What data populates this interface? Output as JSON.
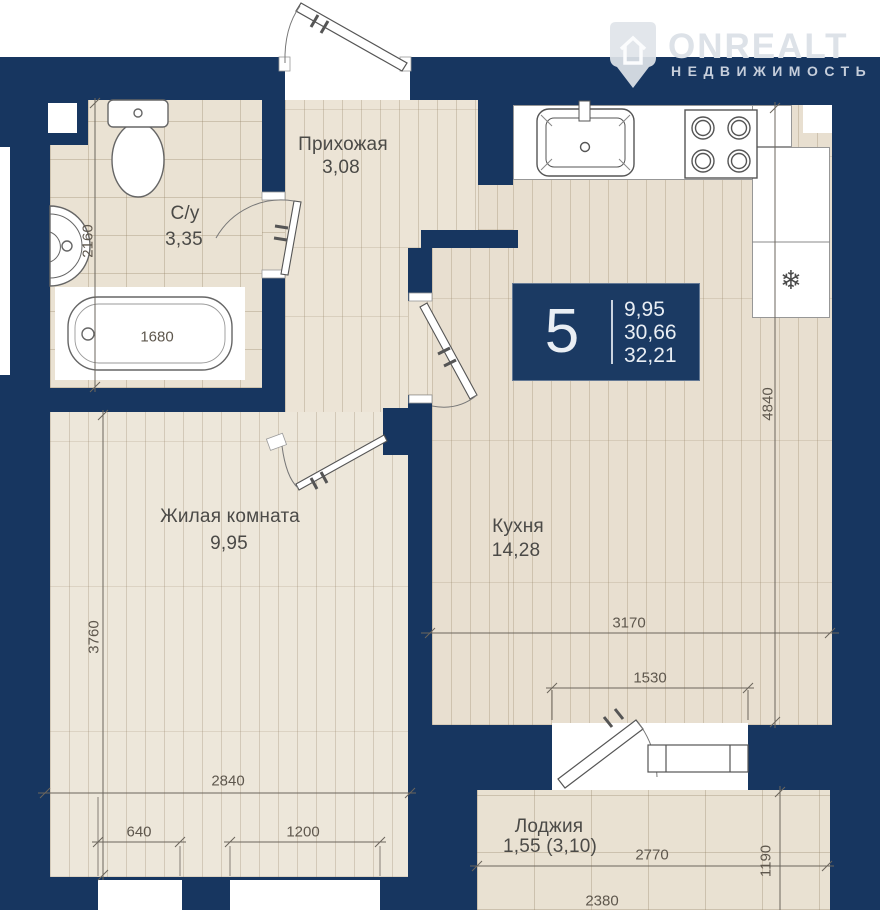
{
  "logo": {
    "brand": "ONREALT",
    "tagline": "НЕДВИЖИМОСТЬ"
  },
  "info_box": {
    "number": "5",
    "values": [
      "9,95",
      "30,66",
      "32,21"
    ]
  },
  "rooms": {
    "hallway": {
      "name": "Прихожая",
      "area": "3,08"
    },
    "bathroom": {
      "name": "С/у",
      "area": "3,35"
    },
    "living": {
      "name": "Жилая комната",
      "area": "9,95"
    },
    "kitchen": {
      "name": "Кухня",
      "area": "14,28"
    },
    "loggia": {
      "name": "Лоджия",
      "area": "1,55 (3,10)"
    }
  },
  "dimensions": {
    "bathroom_height": "2160",
    "bathtub": "1680",
    "living_height": "3760",
    "living_width": "2840",
    "window_small": "640",
    "window_large": "1200",
    "kitchen_height": "4840",
    "kitchen_width": "3170",
    "balcony_unit": "1530",
    "loggia_width": "2770",
    "loggia_depth": "1190",
    "loggia_bottom": "2380"
  },
  "icons": {
    "fridge": "❄"
  },
  "colors": {
    "wall_navy": "#173660",
    "floor_beige": "#eae2d3",
    "fixture_white": "#ffffff"
  }
}
